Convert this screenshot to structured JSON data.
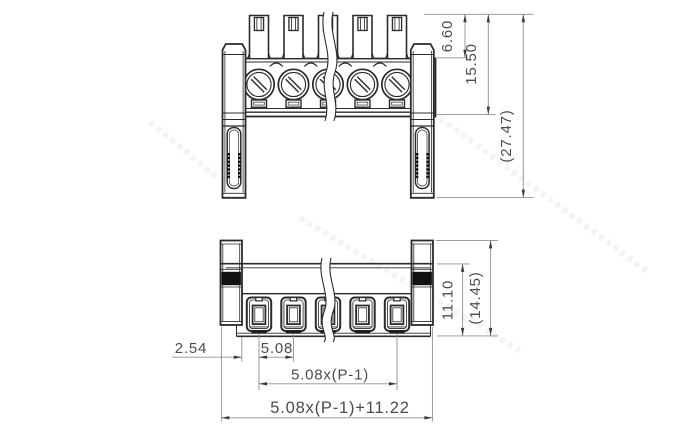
{
  "dimensions": {
    "front_view": {
      "pin_exposure": "6.60",
      "upper_body_height": "15.50",
      "overall_height": "(27.47)"
    },
    "bottom_view": {
      "edge_to_first_pole": "2.54",
      "pole_pitch": "5.08",
      "pole_span": "5.08x(P-1)",
      "overall_width": "5.08x(P-1)+11.22",
      "body_height": "11.10",
      "overall_depth": "(14.45)"
    }
  }
}
